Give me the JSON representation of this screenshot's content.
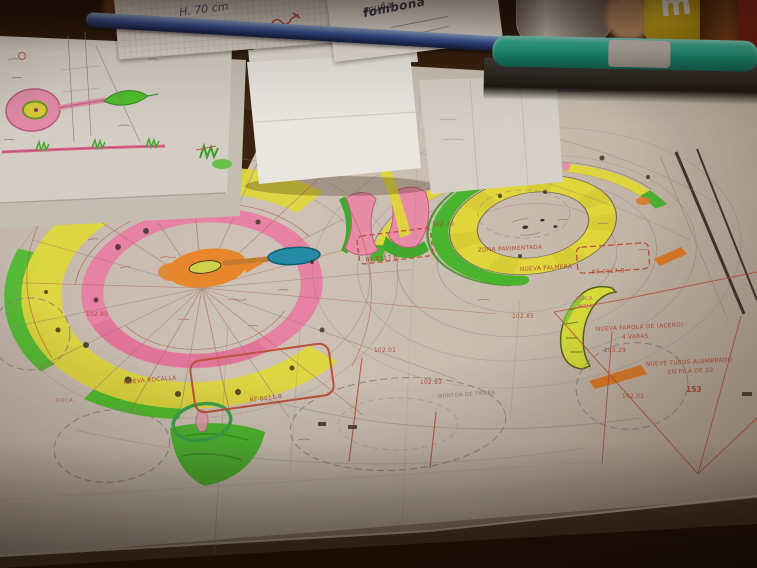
{
  "scene": {
    "type": "photograph",
    "description": "Hand-coloured landscape garden plans (circular planting beds in green, yellow, pink, orange highlighter) spread on a desk, photographed at an angle in dim warm light, with a blue pen, teal pencil case, frosted glass, yellow M&M mug and folded papers around",
    "palette": {
      "table_dark": "#201008",
      "paper_main": "#cdc2b6",
      "paper_bright": "#f0eee9",
      "highlight_green": "#4fc32f",
      "highlight_yellow": "#e5de3e",
      "highlight_pink": "#ee8fae",
      "highlight_orange": "#ee8a2b",
      "teal_marker": "#2090ad",
      "red_ink": "#b5493a",
      "pencil_grey": "#8d8276",
      "pen_blue": "#35539e",
      "pencilcase_teal": "#108a70",
      "mug_yellow": "#e8c61f"
    }
  },
  "desk": {
    "logo_prefix": "acuña",
    "logo_main": "fombona",
    "note_measure": "H. 70 cm",
    "notepad_measure": "5.83 cm",
    "mug_letter": "m"
  },
  "plan_labels": {
    "rf_top": "RF-0117-T",
    "rf_sail": "RF 0117 B",
    "rf_right": "RF-0117-B",
    "rf_bottom": "RF-0011-B",
    "zona": "ZONA PAVIMENTADA",
    "palmera": "NUEVA PALMERA",
    "rocalla": "NUEVA ROCALLA",
    "roca_left": "ROCA",
    "roca_right_line1": "ROCA",
    "roca_right_line2": "ROJA",
    "farola_line1": "NUEVA FAROLA DE (ACERO)",
    "farola_line2": "4 VARAS",
    "tubos_line1": "NUEVE TUBOS ALUMBRADO",
    "tubos_line2": "EN FILA DE 10",
    "tierra": "MONTÓN DE TIERRA",
    "n153": "153",
    "lvl_10270": "102.70",
    "lvl_10285": "102.85",
    "lvl_10293": "102.93",
    "lvl_10201_a": "102.01",
    "lvl_10201_b": "102.01",
    "lvl_10329": "103.29",
    "lvl_10280": "102.80"
  }
}
